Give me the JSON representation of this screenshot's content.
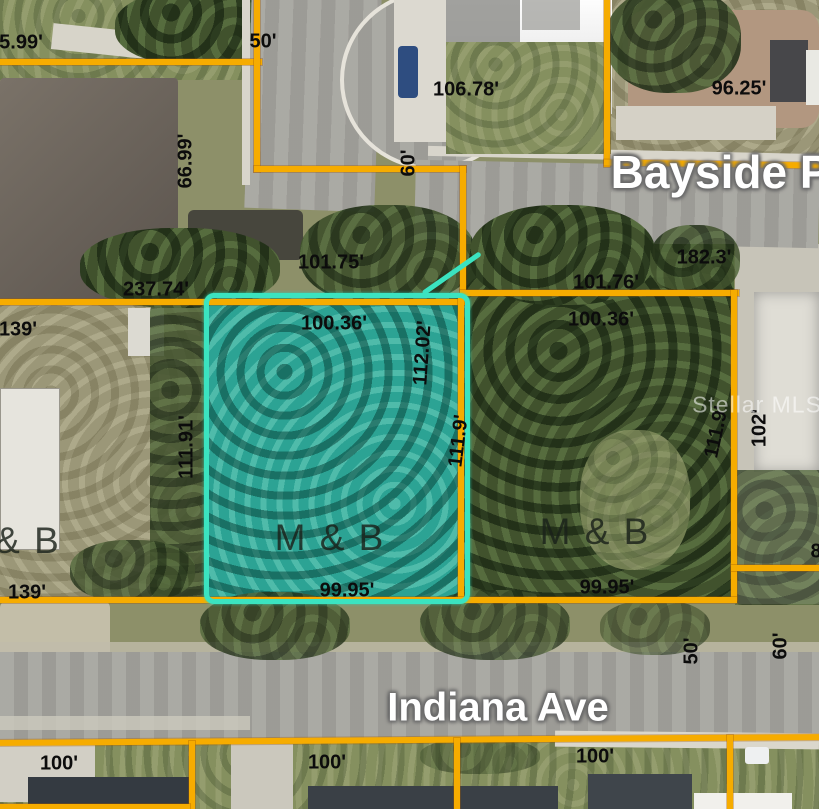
{
  "map": {
    "type": "aerial-parcel-map",
    "streets": {
      "bayside": "Bayside Pl",
      "indiana": "Indiana Ave"
    },
    "watermark": "Stellar MLS",
    "highlighted_lot_label": "M & B"
  },
  "colors": {
    "parcel_line": "#F6AC00",
    "highlight_border": "#3BE3C0",
    "highlight_fill": "#2CA394"
  },
  "labels": [
    {
      "id": "dim-75-99",
      "t": "5.99'",
      "x": 21,
      "y": 43
    },
    {
      "id": "dim-50-top",
      "t": "50'",
      "x": 263,
      "y": 42
    },
    {
      "id": "dim-106-78",
      "t": "106.78'",
      "x": 466,
      "y": 90
    },
    {
      "id": "dim-96-25",
      "t": "96.25'",
      "x": 739,
      "y": 89
    },
    {
      "id": "dim-66-99",
      "t": "66.99'",
      "x": 186,
      "y": 161,
      "rot": -90
    },
    {
      "id": "dim-60-street",
      "t": "60'",
      "x": 409,
      "y": 163,
      "rot": -90
    },
    {
      "id": "street-bayside",
      "t": "Bayside Pl",
      "x": 727,
      "y": 172,
      "cls": "street lg"
    },
    {
      "id": "dim-101-75",
      "t": "101.75'",
      "x": 331,
      "y": 263
    },
    {
      "id": "dim-182-3",
      "t": "182.3'",
      "x": 704,
      "y": 258
    },
    {
      "id": "dim-237-74",
      "t": "237.74'",
      "x": 156,
      "y": 290
    },
    {
      "id": "dim-139-top",
      "t": "139'",
      "x": 18,
      "y": 330
    },
    {
      "id": "dim-100-36-a",
      "t": "100.36'",
      "x": 334,
      "y": 324
    },
    {
      "id": "dim-101-76",
      "t": "101.76'",
      "x": 606,
      "y": 283
    },
    {
      "id": "dim-100-36-b",
      "t": "100.36'",
      "x": 601,
      "y": 320
    },
    {
      "id": "dim-112-02",
      "t": "112.02'",
      "x": 423,
      "y": 353,
      "rot": -86
    },
    {
      "id": "dim-111-91",
      "t": "111.91'",
      "x": 187,
      "y": 447,
      "rot": -90
    },
    {
      "id": "dim-111-9-a",
      "t": "111.9'",
      "x": 459,
      "y": 441,
      "rot": -83
    },
    {
      "id": "dim-111-9-b",
      "t": "111.9'",
      "x": 717,
      "y": 432,
      "rot": -78
    },
    {
      "id": "dim-102",
      "t": "102'",
      "x": 760,
      "y": 428,
      "rot": -90
    },
    {
      "id": "label-mb-a",
      "t": "M & B",
      "x": 330,
      "y": 538,
      "cls": "mb"
    },
    {
      "id": "label-mb-b",
      "t": "M & B",
      "x": 595,
      "y": 532,
      "cls": "mb"
    },
    {
      "id": "label-mb-left",
      "t": "& B",
      "x": 28,
      "y": 541,
      "cls": "mb"
    },
    {
      "id": "dim-99-95-a",
      "t": "99.95'",
      "x": 347,
      "y": 591
    },
    {
      "id": "dim-99-95-b",
      "t": "99.95'",
      "x": 607,
      "y": 588
    },
    {
      "id": "dim-139-bottom",
      "t": "139'",
      "x": 27,
      "y": 593
    },
    {
      "id": "dim-50-bottom",
      "t": "50'",
      "x": 692,
      "y": 651,
      "rot": -90
    },
    {
      "id": "dim-60-bottom",
      "t": "60'",
      "x": 781,
      "y": 646,
      "rot": -90
    },
    {
      "id": "street-indiana",
      "t": "Indiana Ave",
      "x": 498,
      "y": 708,
      "cls": "street md"
    },
    {
      "id": "dim-100-a",
      "t": "100'",
      "x": 59,
      "y": 764
    },
    {
      "id": "dim-100-b",
      "t": "100'",
      "x": 327,
      "y": 763
    },
    {
      "id": "dim-100-c",
      "t": "100'",
      "x": 595,
      "y": 757
    },
    {
      "id": "dim-8-partial",
      "t": "8",
      "x": 816,
      "y": 552
    },
    {
      "id": "watermark",
      "t": "Stellar MLS",
      "x": 757,
      "y": 405,
      "cls": "wm"
    }
  ]
}
